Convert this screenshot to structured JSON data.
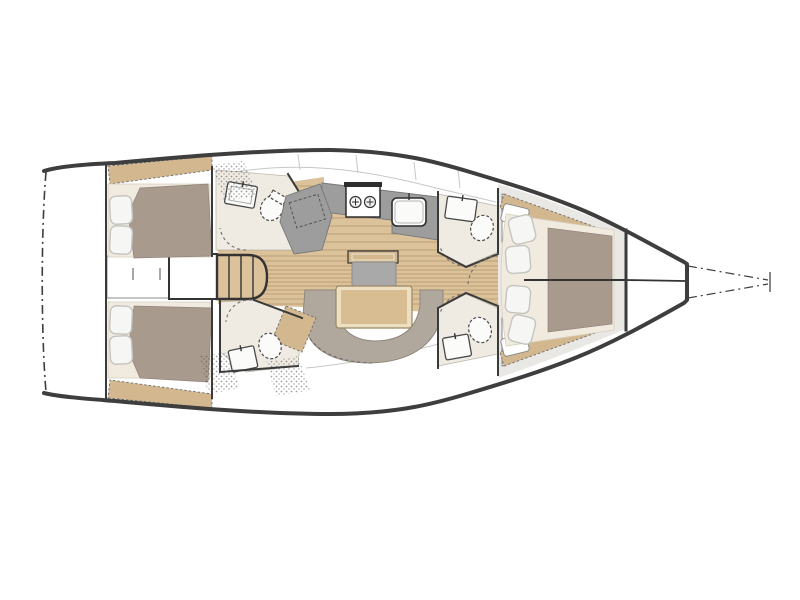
{
  "image": {
    "width": 800,
    "height": 600,
    "background": "#ffffff",
    "description_of_depiction": "top-view sailing yacht interior layout plan, bow to the right, stern to the left"
  },
  "colors": {
    "hull_line": "#3e3e3e",
    "wall": "#3a3a3a",
    "deck_grey": "#eae8e5",
    "floor_wood": "#dcc29b",
    "plank_line": "#b2946c",
    "shelf_wood": "#d3b88f",
    "mattress": "#a89a8d",
    "pillow": "#f6f6f4",
    "pillow_line": "#c4c4c0",
    "bed_platform": "#f1ebdf",
    "counter_grey": "#9d9d9d",
    "cushion_grey": "#a9a9a9",
    "sofa": "#b1a89d",
    "table_rim": "#ecdfc2",
    "table_wood": "#d9bd92",
    "head_floor": "#efebe3",
    "fixture": "#fbfbfa",
    "fixture_line": "#4a4a4a",
    "dash": "#6e6e6e",
    "stipple": "#4f4f4f"
  },
  "features": [
    "hull-outline",
    "swim-platform-outline",
    "bowsprit-outline",
    "transom-bulkhead",
    "aft-port-cabin-double-berth",
    "aft-starboard-cabin-double-berth",
    "stern-cabinet",
    "engine-compartment",
    "companionway-steps",
    "aft-port-head-with-sink-and-toilet",
    "aft-starboard-head-with-sink-and-toilet",
    "galley-counter",
    "two-burner-stove",
    "galley-sink",
    "salon-settee-bench",
    "dinette-table",
    "u-shaped-sofa",
    "forward-port-head",
    "forward-starboard-head",
    "hanging-locker-port",
    "hanging-locker-starboard",
    "forward-cabin-v-berth",
    "berth-center-seam",
    "collision-bulkhead",
    "bow-anchor-locker"
  ]
}
